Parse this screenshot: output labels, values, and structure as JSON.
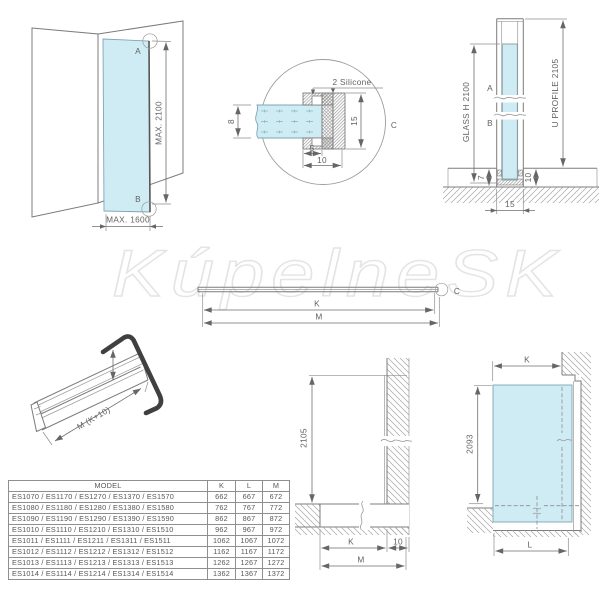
{
  "watermark": "KúpelneSK",
  "colors": {
    "glass": "#cfecf5",
    "line": "#7c7c7c",
    "text": "#636363",
    "watermark": "#e4e4e4",
    "end_clip": "#404040"
  },
  "labels": {
    "panel_view": {
      "point_a": "A",
      "point_b": "B",
      "max_height": "MAX. 2100",
      "max_width": "MAX. 1600"
    },
    "detail_view": {
      "silicone": "2 Silicone",
      "glass_thickness": "8",
      "profile_height": "15",
      "inner_depth": "5",
      "outer_depth": "10",
      "detail_label": "C"
    },
    "side_view": {
      "glass_height": "GLASS H 2100",
      "profile_height": "U PROFILE 2105",
      "point_a": "A",
      "point_b": "B",
      "dim_7": "7",
      "dim_10": "10",
      "dim_15": "15"
    },
    "profile_bar": {
      "dim_k": "K",
      "dim_m": "M",
      "detail_label": "C"
    },
    "iso_view": {
      "length": "M (K+10)"
    },
    "wall_section": {
      "height": "2105",
      "dim_k": "K",
      "dim_10": "10",
      "dim_m": "M"
    },
    "front_view": {
      "dim_k": "K",
      "glass_height": "2093",
      "dim_l": "L"
    }
  },
  "table": {
    "headers": [
      "MODEL",
      "K",
      "L",
      "M"
    ],
    "rows": [
      {
        "model": "ES1070 / ES1170 / ES1270 / ES1370 / ES1570",
        "k": "662",
        "l": "667",
        "m": "672"
      },
      {
        "model": "ES1080 / ES1180 / ES1280 / ES1380 / ES1580",
        "k": "762",
        "l": "767",
        "m": "772"
      },
      {
        "model": "ES1090 / ES1190 / ES1290 / ES1390 / ES1590",
        "k": "862",
        "l": "867",
        "m": "872"
      },
      {
        "model": "ES1010 / ES1110 / ES1210 / ES1310 / ES1510",
        "k": "962",
        "l": "967",
        "m": "972"
      },
      {
        "model": "ES1011 / ES1111 / ES1211 / ES1311 / ES1511",
        "k": "1062",
        "l": "1067",
        "m": "1072"
      },
      {
        "model": "ES1012 / ES1112 / ES1212 / ES1312 / ES1512",
        "k": "1162",
        "l": "1167",
        "m": "1172"
      },
      {
        "model": "ES1013 / ES1113 / ES1213 / ES1313 / ES1513",
        "k": "1262",
        "l": "1267",
        "m": "1272"
      },
      {
        "model": "ES1014 / ES1114 / ES1214 / ES1314 / ES1514",
        "k": "1362",
        "l": "1367",
        "m": "1372"
      }
    ]
  }
}
